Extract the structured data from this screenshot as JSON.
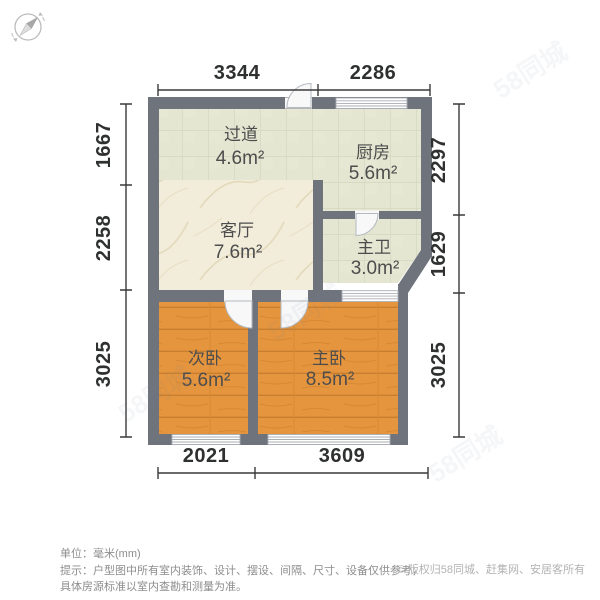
{
  "meta": {
    "unit_note": "单位：毫米(mm)",
    "tip_line1": "提示：户型图中所有室内装饰、设计、摆设、间隔、尺寸、设备仅供参考，",
    "tip_line2": "具体房源标准以室内查勘和测量为准。",
    "copyright": "© 版权归58同城、赶集网、安居客所有",
    "watermark": "58同城"
  },
  "colors": {
    "wall": "#6f747c",
    "tile_floor": "#e4e6d1",
    "tile_line": "#d4d7bf",
    "marble_floor": "#f2ecda",
    "wood_floor": "#e5953e",
    "wood_line": "#c87e2f",
    "dim_line": "#3a3a3a",
    "fixture_white": "#f8f8f9"
  },
  "rooms": [
    {
      "name": "过道",
      "area": "4.6m²"
    },
    {
      "name": "厨房",
      "area": "5.6m²"
    },
    {
      "name": "客厅",
      "area": "7.6m²"
    },
    {
      "name": "主卫",
      "area": "3.0m²"
    },
    {
      "name": "次卧",
      "area": "5.6m²"
    },
    {
      "name": "主卧",
      "area": "8.5m²"
    }
  ],
  "dims": {
    "top": [
      "3344",
      "2286"
    ],
    "bottom": [
      "2021",
      "3609"
    ],
    "left": [
      "1667",
      "2258",
      "3025"
    ],
    "right": [
      "2297",
      "1629",
      "3025"
    ]
  }
}
